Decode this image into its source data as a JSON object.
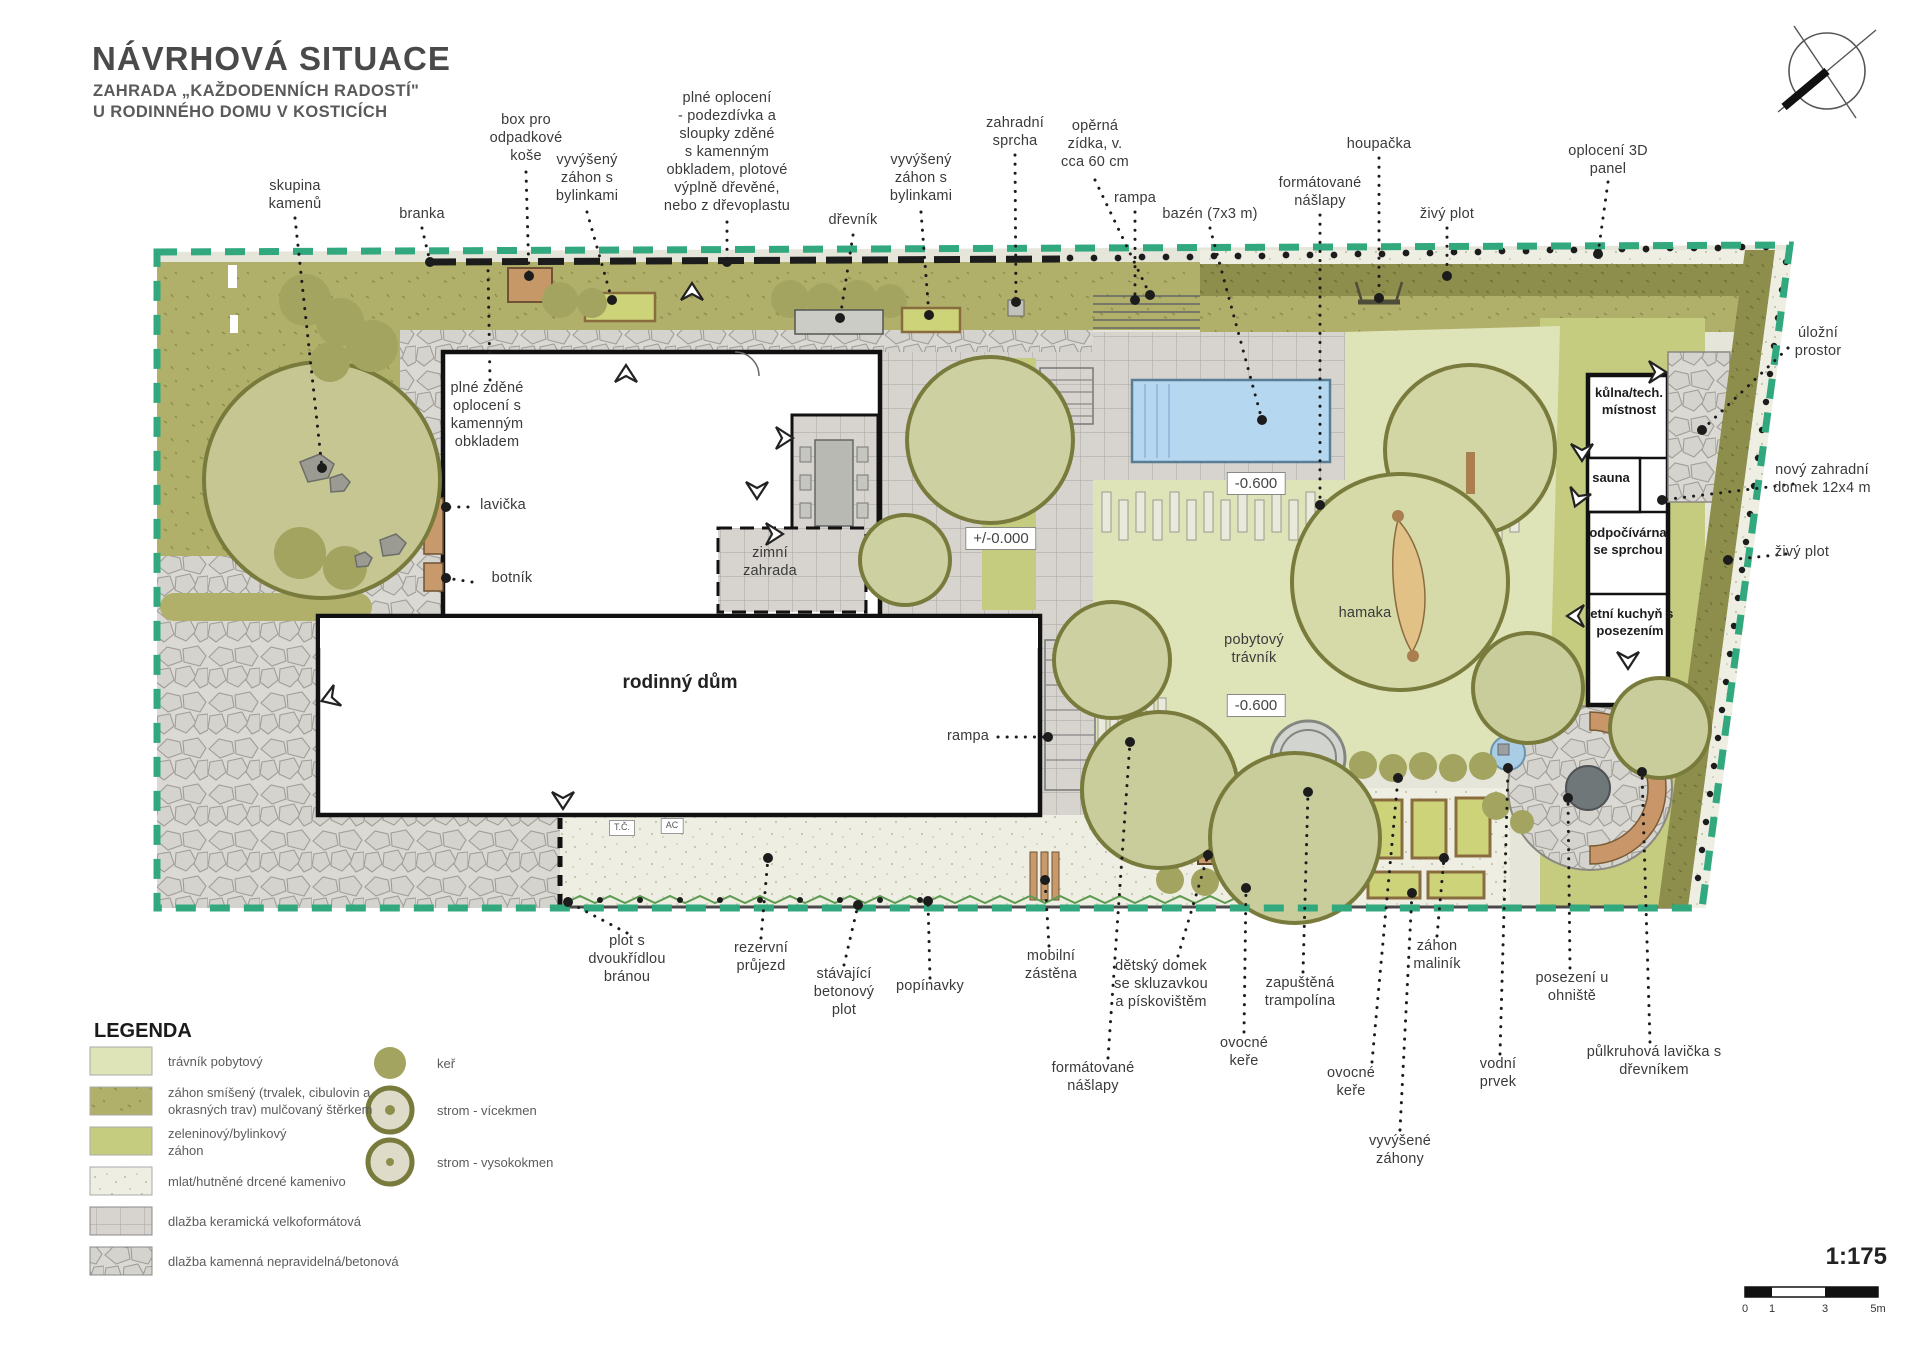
{
  "title": {
    "main": "NÁVRHOVÁ SITUACE",
    "sub1": "ZAHRADA „KAŽDODENNÍCH RADOSTÍ\"",
    "sub2": "U RODINNÉHO DOMU V KOSTICÍCH"
  },
  "labels": {
    "skupina_kamenu": "skupina\nkamenů",
    "branka": "branka",
    "box_odpad": "box pro\nodpadkové\nkoše",
    "zahon_bylinky_1": "vyvýšený\nzáhon s\nbylinkami",
    "plne_oploceni": "plné oplocení\n- podezdívka a\nsloupky zděné\ns kamenným\nobkladem, plotové\nvýplně dřevěné,\nnebo z dřevoplastu",
    "drevnik": "dřevník",
    "zahon_bylinky_2": "vyvýšený\nzáhon s\nbylinkami",
    "zahradni_sprcha": "zahradní\nsprcha",
    "rampa_top": "rampa",
    "operna_zidka": "opěrná\nzídka, v.\ncca 60 cm",
    "bazen": "bazén (7x3 m)",
    "formatovane_naslapy_top": "formátované\nnášlapy",
    "houpacka": "houpačka",
    "zivy_plot_top": "živý plot",
    "oploceni_3d": "oplocení 3D\npanel",
    "ulozni_prostor": "úložní\nprostor",
    "novy_domek": "nový zahradní\ndomek 12x4 m",
    "zivy_plot_right": "živý plot",
    "plne_zdene": "plné zděné\noplocení s\nkamenným\nobkladem",
    "lavicka": "lavička",
    "botnik": "botník",
    "zimni_zahrada": "zimní\nzahrada",
    "rodinny_dum": "rodinný dům",
    "level_0": "+/-0.000",
    "level_m600_a": "-0.600",
    "level_m600_b": "-0.600",
    "pobytovy_travnik": "pobytový\ntrávník",
    "hamaka": "hamaka",
    "rampa_inner": "rampa",
    "tc": "T.Č.",
    "ac": "AC",
    "kulna": "kůlna/tech.\nmístnost",
    "sauna": "sauna",
    "odpocivarna": "odpočívárna\nse sprchou",
    "letni_kuchyn": "letní kuchyň s\nposezením",
    "plot_brana": "plot s\ndvoukřídlou\nbránou",
    "rezervni_prujezd": "rezervní\nprůjezd",
    "stavajici_plot": "stávající\nbetonový\nplot",
    "popinavky": "popínavky",
    "mobilni_zastena": "mobilní\nzástěna",
    "formatovane_naslapy_bottom": "formátované\nnášlapy",
    "detsky_domek": "dětský domek\nse skluzavkou\na pískovištěm",
    "ovocne_kere_a": "ovocné\nkeře",
    "zapustena_trampolina": "zapuštěná\ntrampolína",
    "ovocne_kere_b": "ovocné\nkeře",
    "vyvysene_zahony": "vyvýšené\nzáhony",
    "zahon_malinik": "záhon\nmaliník",
    "vodni_prvek": "vodní\nprvek",
    "posezeni_ohniste": "posezení u\nohniště",
    "pulkruhova_lavicka": "půlkruhová lavička s\ndřevníkem"
  },
  "legend": {
    "heading": "LEGENDA",
    "items": [
      "trávník pobytový",
      "záhon smíšený (trvalek, cibulovin a\nokrasných trav) mulčovaný štěrkem",
      "zeleninový/bylinkový\nzáhon",
      "mlat/hutněné drcené kamenivo",
      "dlažba keramická velkoformátová",
      "dlažba kamenná nepravidelná/betonová"
    ],
    "tree_items": [
      "keř",
      "strom - vícekmen",
      "strom -  vysokokmen"
    ]
  },
  "scale": {
    "ratio": "1:175",
    "ticks": [
      "0",
      "1",
      "3",
      "5m"
    ]
  },
  "colors": {
    "boundary_teal": "#31a87e",
    "lawn_olive": "#b1b06a",
    "lawn_light": "#dfe3b8",
    "bed_yellow_green": "#c5cc80",
    "hedge_dark": "#8d8e4b",
    "pool_blue": "#b5d8f0",
    "wood_tan": "#c89a6b"
  }
}
